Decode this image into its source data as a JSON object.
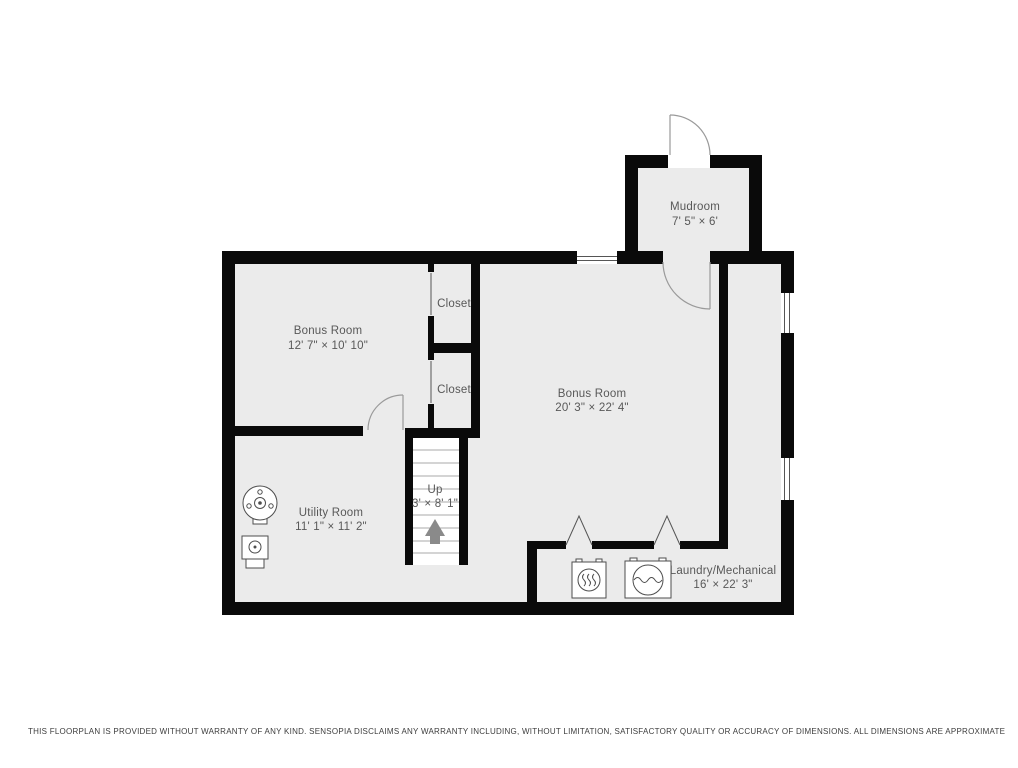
{
  "title": "Basement floor plan",
  "rooms": {
    "mudroom": {
      "name": "Mudroom",
      "dims": "7' 5\" × 6'"
    },
    "bonus_left": {
      "name": "Bonus Room",
      "dims": "12' 7\" × 10' 10\""
    },
    "bonus_main": {
      "name": "Bonus Room",
      "dims": "20' 3\" × 22' 4\""
    },
    "closet_top": {
      "name": "Closet"
    },
    "closet_bottom": {
      "name": "Closet"
    },
    "utility": {
      "name": "Utility Room",
      "dims": "11' 1\" × 11' 2\""
    },
    "laundry": {
      "name": "Laundry/Mechanical",
      "dims": "16' × 22' 3\""
    },
    "stairs": {
      "name": "Up",
      "dims": "3' × 8' 1\""
    }
  },
  "icons": {
    "water_heater": "water-heater-top-view",
    "furnace": "furnace-top-view",
    "dryer": "dryer-icon",
    "washer": "washer-icon",
    "up_arrow": "stairs-up-arrow"
  },
  "colors": {
    "wall": "#0a0a0a",
    "floor": "#ebebeb",
    "stairwell_floor": "#ffffff",
    "label_text": "#585858",
    "door_arc": "#9a9a9a",
    "arrow": "#8a8a8a",
    "disclaimer_text": "#3d3d3d"
  },
  "disclaimer": "THIS FLOORPLAN IS PROVIDED WITHOUT WARRANTY OF ANY KIND. SENSOPIA DISCLAIMS ANY WARRANTY INCLUDING, WITHOUT LIMITATION, SATISFACTORY QUALITY OR ACCURACY OF DIMENSIONS. ALL DIMENSIONS ARE APPROXIMATE"
}
